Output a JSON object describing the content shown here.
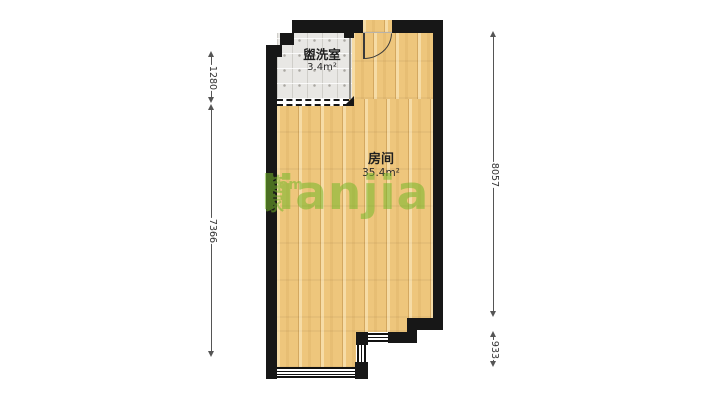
{
  "floorplan": {
    "rooms": [
      {
        "name": "盥洗室",
        "area": "3.4m²"
      },
      {
        "name": "房间",
        "area": "35.4m²"
      }
    ],
    "dimensions_mm": {
      "left_upper": "1280",
      "left_lower": "7366",
      "right_upper": "8057",
      "right_lower": "933"
    },
    "watermark": {
      "logo": "Lianjia",
      "logo_cn": "链家",
      "logo_tld": ".com"
    },
    "colors": {
      "wall": "#171717",
      "wood_floor": "#eec67c",
      "tile_floor": "#e8e7e4",
      "watermark_green": "#76b82a",
      "dimension": "#555555"
    }
  }
}
